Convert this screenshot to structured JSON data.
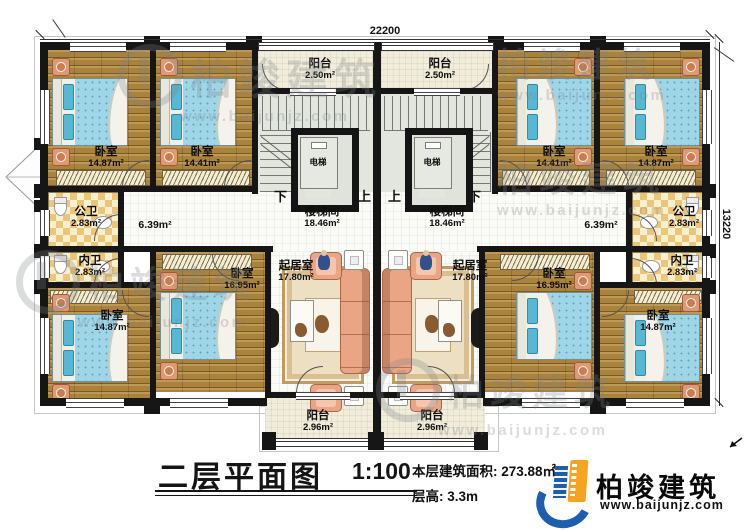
{
  "drawing": {
    "dimension_top": "22200",
    "dimension_right": "13220"
  },
  "rooms": {
    "bedroom_a": {
      "name": "卧室",
      "area": "14.87m²"
    },
    "bedroom_b": {
      "name": "卧室",
      "area": "14.41m²"
    },
    "bedroom_c": {
      "name": "卧室",
      "area": "16.95m²"
    },
    "living_room": {
      "name": "起居室",
      "area": "17.80m²"
    },
    "balcony_top": {
      "name": "阳台",
      "area": "2.50m²"
    },
    "balcony_bottom": {
      "name": "阳台",
      "area": "2.96m²"
    },
    "stair_hall": {
      "name": "楼梯间",
      "area": "18.46m²"
    },
    "corridor": {
      "area": "6.39m²"
    },
    "public_bathroom": {
      "name": "公卫",
      "area": "2.83m²"
    },
    "private_bathroom": {
      "name": "内卫",
      "area": "2.83m²"
    },
    "elevator": {
      "name": "电梯"
    },
    "stair_down": "下",
    "stair_up": "上"
  },
  "title_block": {
    "title": "二层平面图",
    "scale": "1:100",
    "area_label": "本层建筑面积:",
    "area_value": "273.88㎡",
    "floor_height_label": "层高:",
    "floor_height_value": "3.3m"
  },
  "brand": {
    "name": "柏竣建筑",
    "url": "www.baijunjz.com"
  },
  "watermark": {
    "name": "柏竣建筑",
    "url": "www.baijunjz.com"
  },
  "colors": {
    "wall": "#161616",
    "wood_floor": "#a9823b",
    "bed_blue": "#9ed6e8",
    "bath_tile": "#ecc678",
    "sofa": "#eaa584",
    "stair_floor": "#e2e6df",
    "brand_blue": "#1d5fae",
    "brand_orange": "#f6a41f"
  }
}
